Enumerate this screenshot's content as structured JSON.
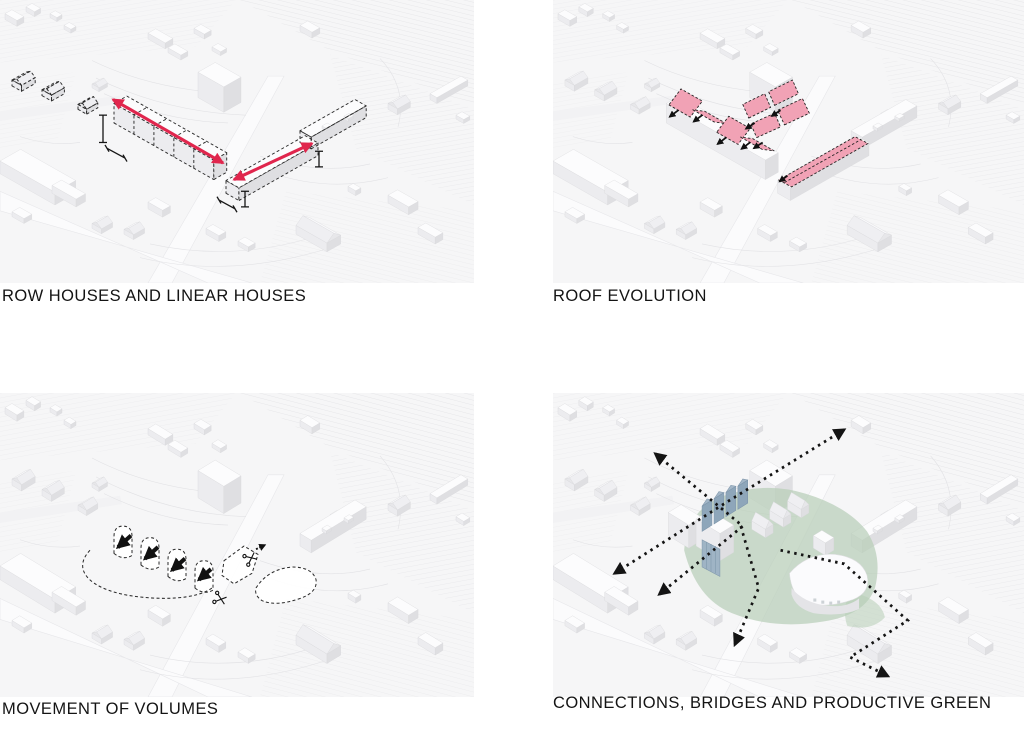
{
  "figure": {
    "panels": [
      {
        "id": "row-houses",
        "label": "ROW HOUSES AND LINEAR HOUSES"
      },
      {
        "id": "roof-evolution",
        "label": "ROOF EVOLUTION"
      },
      {
        "id": "movement-of-volumes",
        "label": "MOVEMENT OF VOLUMES"
      },
      {
        "id": "connections",
        "label": "CONNECTIONS, BRIDGES AND PRODUCTIVE GREEN"
      }
    ],
    "colors": {
      "accent_red": "#e0264d",
      "roof_pink": "#f1a2b5",
      "productive_green": "#b7cdb7",
      "bridge_blue": "#8ea6ba",
      "ink": "#141414",
      "model_white": "#fcfcfd"
    },
    "icons": {
      "direction_arrow": "red double-headed arrow",
      "movement_arrow": "solid black arrow",
      "scissors": "cut marker of two crossed blades",
      "circulation_arrow": "black dotted path with solid arrowhead",
      "dimension_marker": "black measurement bar with end caps"
    }
  }
}
